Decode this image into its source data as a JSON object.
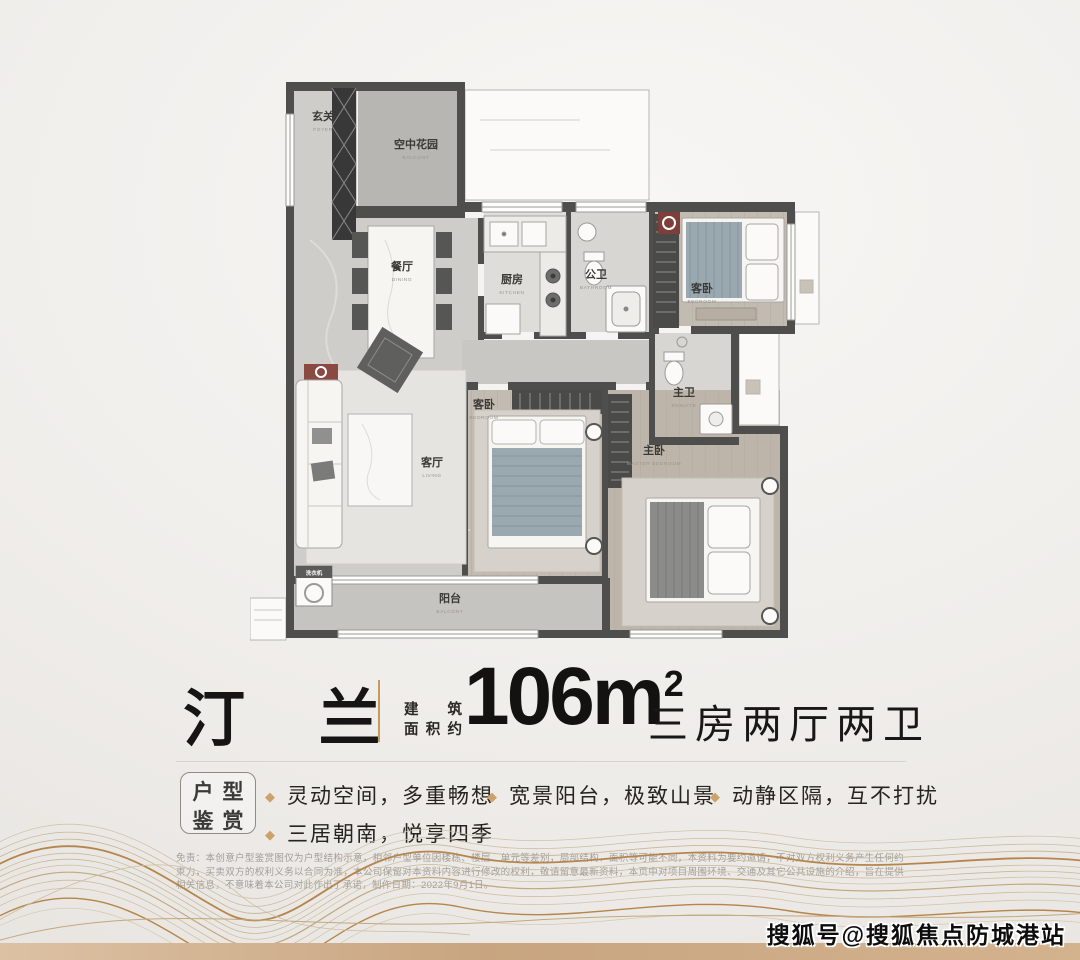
{
  "poster": {
    "title": {
      "name": "汀 兰"
    },
    "area": {
      "prefix_line1": "建 筑",
      "prefix_line2": "面积约",
      "value": "106m",
      "sup": "2",
      "layout": "三房两厅两卫"
    },
    "features": {
      "badge_line1": "户型",
      "badge_line2": "鉴赏",
      "bullet_glyph": "◆",
      "items": [
        "灵动空间，多重畅想",
        "宽景阳台，极致山景",
        "动静区隔，互不打扰",
        "三居朝南，悦享四季"
      ]
    },
    "disclaimer": "免责：本创意户型鉴赏图仅为户型结构示意，相邻户型单位因楼栋、楼层、单元等差别，局部结构、面积等可能不同，本资料为要约邀请，不对双方权利义务产生任何约束力，买卖双方的权利义务以合同为准，本公司保留对本资料内容进行修改的权利，敬请留意最新资料，本页中对项目周围环境、交通及其它公共设施的介绍，旨在提供相关信息，不意味着本公司对此作出了承诺，制作日期：2022年9月1日。",
    "watermark": "搜狐号@搜狐焦点防城港站"
  },
  "floorplan": {
    "rooms": [
      {
        "key": "foyer",
        "cn": "玄关",
        "en": "FOYER"
      },
      {
        "key": "sky-garden",
        "cn": "空中花园",
        "en": "BALCONY"
      },
      {
        "key": "dining",
        "cn": "餐厅",
        "en": "DINING"
      },
      {
        "key": "kitchen",
        "cn": "厨房",
        "en": "KITCHEN"
      },
      {
        "key": "guest-bath",
        "cn": "公卫",
        "en": "BATHROOM"
      },
      {
        "key": "bedroom-north",
        "cn": "客卧",
        "en": "BEDROOM"
      },
      {
        "key": "ensuite",
        "cn": "主卫",
        "en": "ENSUITE"
      },
      {
        "key": "living",
        "cn": "客厅",
        "en": "LIVING"
      },
      {
        "key": "bedroom-middle",
        "cn": "客卧",
        "en": "BEDROOM"
      },
      {
        "key": "master",
        "cn": "主卧",
        "en": "MASTER BEDROOM"
      },
      {
        "key": "balcony",
        "cn": "阳台",
        "en": "BALCONY"
      },
      {
        "key": "washer",
        "cn": "洗衣机",
        "en": ""
      }
    ]
  },
  "colors": {
    "accent_gold": "#c49a62",
    "wall": "#4e4e4c",
    "marble_floor": "#cfcdca",
    "wood_floor": "#c2bbb1",
    "blanket_blue": "#9aa8b0",
    "bottom_bar": "#c8a580"
  }
}
